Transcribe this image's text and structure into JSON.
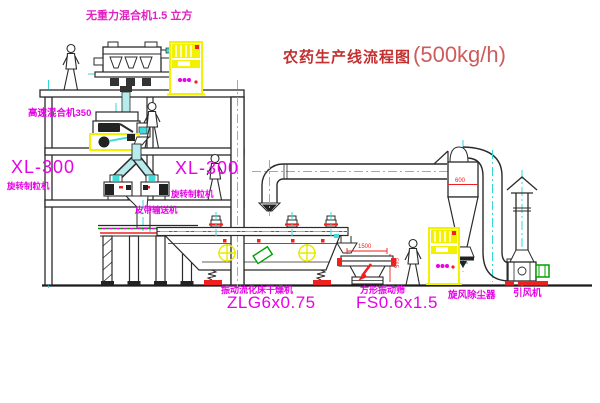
{
  "title": {
    "text": "农药生产线流程图",
    "capacity": "(500kg/h)"
  },
  "equipment_labels": {
    "gravity_mixer": "无重力混合机1.5 立方",
    "high_speed_mixer": "高速混合机350",
    "granulator_left_model": "XL-300",
    "granulator_left_name": "旋转制粒机",
    "granulator_right_model": "XL-300",
    "granulator_right_name": "旋转制粒机",
    "belt_conveyor": "皮带输送机",
    "dryer_name": "振动流化床干燥机",
    "dryer_model": "ZLG6x0.75",
    "screen_name": "方形振动筛",
    "screen_model": "FS0.6x1.5",
    "cyclone": "旋风除尘器",
    "fan": "引风机"
  },
  "dimensions": {
    "screen_length": "1500",
    "screen_height": "565",
    "cyclone_diameter": "600"
  },
  "colors": {
    "label_magenta": "#e800e8",
    "title_red": "#c23030",
    "dimension_red": "#f02020",
    "duct_cyan": "#35d8d8",
    "cabinet_yellow": "#f2f200",
    "motor_green": "#00a000"
  }
}
